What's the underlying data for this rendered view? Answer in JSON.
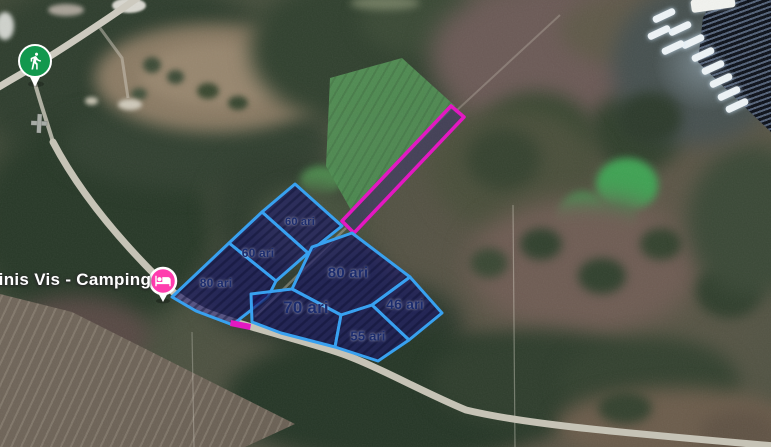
{
  "map": {
    "type": "satellite-map",
    "poi": {
      "camping": {
        "label": "ninis Vis - Camping",
        "pin_color": "#ff3cae",
        "icon": "bed-icon"
      },
      "trailhead": {
        "pin_color": "#12984e",
        "icon": "hiker-icon"
      }
    },
    "parcels": [
      {
        "id": "60-top",
        "label": "60 ari",
        "points": [
          [
            295,
            184
          ],
          [
            342,
            226
          ],
          [
            308,
            253
          ],
          [
            262,
            212
          ]
        ],
        "label_x": 300,
        "label_y": 222,
        "font": 11
      },
      {
        "id": "60-mid",
        "label": "60 ari",
        "points": [
          [
            262,
            212
          ],
          [
            308,
            253
          ],
          [
            276,
            281
          ],
          [
            229,
            243
          ]
        ],
        "label_x": 258,
        "label_y": 253,
        "font": 12
      },
      {
        "id": "80-left",
        "label": "80 ari",
        "points": [
          [
            229,
            243
          ],
          [
            276,
            281
          ],
          [
            268,
            297
          ],
          [
            241,
            318
          ],
          [
            233,
            325
          ],
          [
            196,
            311
          ],
          [
            172,
            297
          ]
        ],
        "label_x": 216,
        "label_y": 283,
        "font": 12
      },
      {
        "id": "80-center",
        "label": "80 ari",
        "points": [
          [
            312,
            247
          ],
          [
            352,
            233
          ],
          [
            410,
            277
          ],
          [
            372,
            305
          ],
          [
            341,
            315
          ],
          [
            292,
            289
          ]
        ],
        "label_x": 348,
        "label_y": 273,
        "font": 15
      },
      {
        "id": "70",
        "label": "70 ari",
        "points": [
          [
            292,
            289
          ],
          [
            341,
            315
          ],
          [
            335,
            347
          ],
          [
            281,
            333
          ],
          [
            252,
            322
          ],
          [
            251,
            294
          ]
        ],
        "label_x": 306,
        "label_y": 308,
        "font": 17
      },
      {
        "id": "46",
        "label": "46 ari",
        "points": [
          [
            410,
            277
          ],
          [
            442,
            313
          ],
          [
            409,
            340
          ],
          [
            372,
            305
          ]
        ],
        "label_x": 405,
        "label_y": 304,
        "font": 14
      },
      {
        "id": "55",
        "label": "55 ari",
        "points": [
          [
            341,
            315
          ],
          [
            372,
            305
          ],
          [
            409,
            340
          ],
          [
            378,
            361
          ],
          [
            335,
            347
          ]
        ],
        "label_x": 368,
        "label_y": 336,
        "font": 13
      }
    ],
    "strip": {
      "color": "#e318c2",
      "points": [
        [
          451,
          106
        ],
        [
          464,
          117
        ],
        [
          354,
          233
        ],
        [
          342,
          221
        ]
      ],
      "tick": [
        [
          231,
          320
        ],
        [
          251,
          324
        ],
        [
          250,
          330
        ],
        [
          230,
          326
        ]
      ]
    },
    "colors": {
      "parcel_outline": "#38a1f0",
      "parcel_fill": "rgba(30,27,105,0.66)",
      "label_text": "#1b2c6e",
      "road": "#c6c3b6"
    }
  }
}
